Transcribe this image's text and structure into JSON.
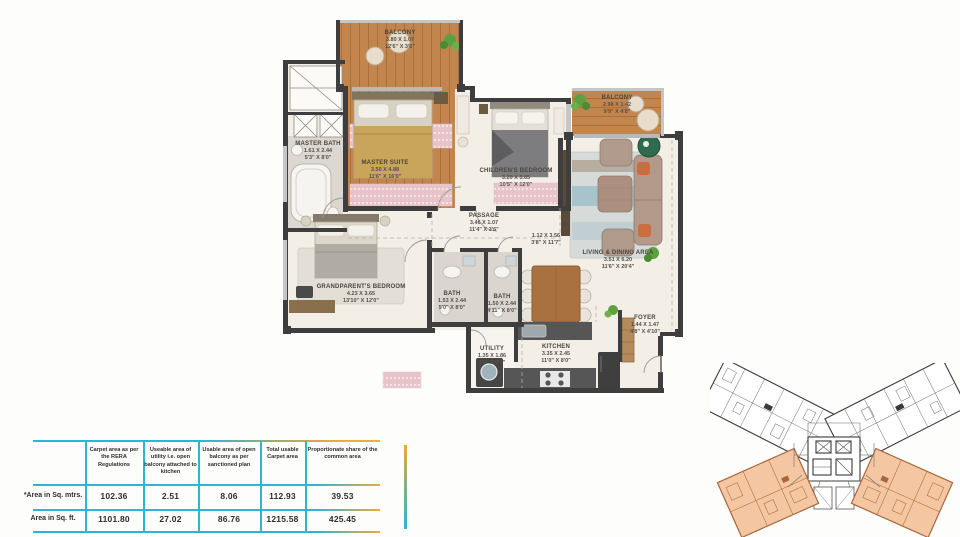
{
  "plan": {
    "rooms": [
      {
        "name": "BALCONY",
        "dim_m": "3.80 X 1.07",
        "dim_ft": "12'6\" X 3'6\""
      },
      {
        "name": "MASTER BATH",
        "dim_m": "1.61 X 2.44",
        "dim_ft": "5'3\" X 8'0\""
      },
      {
        "name": "MASTER SUITE",
        "dim_m": "3.50 X 4.88",
        "dim_ft": "11'6\" X 16'0\""
      },
      {
        "name": "CHILDREN'S BEDROOM",
        "dim_m": "3.20 X 3.65",
        "dim_ft": "10'5\" X 12'0\""
      },
      {
        "name": "BALCONY",
        "dim_m": "2.98 X 1.42",
        "dim_ft": "9'9\" X 4'8\""
      },
      {
        "name": "PASSAGE",
        "dim_m": "3.46 X 1.07",
        "dim_ft": "11'4\" X 3'6\""
      },
      {
        "name": "",
        "dim_m": "1.12 X 3.56",
        "dim_ft": "3'8\" X 11'7\""
      },
      {
        "name": "GRANDPARENT'S BEDROOM",
        "dim_m": "4.23 X 3.65",
        "dim_ft": "13'10\" X 12'0\""
      },
      {
        "name": "BATH",
        "dim_m": "1.53 X 2.44",
        "dim_ft": "5'0\" X 8'0\""
      },
      {
        "name": "BATH",
        "dim_m": "1.50 X 2.44",
        "dim_ft": "4'11\" X 8'0\""
      },
      {
        "name": "LIVING & DINING AREA",
        "dim_m": "3.51 X 6.20",
        "dim_ft": "11'6\" X 20'4\""
      },
      {
        "name": "FOYER",
        "dim_m": "1.44 X 1.47",
        "dim_ft": "4'8\" X 4'10\""
      },
      {
        "name": "UTILITY",
        "dim_m": "1.35 X 1.86",
        "dim_ft": "4'5\" X 6'1\""
      },
      {
        "name": "KITCHEN",
        "dim_m": "3.35 X 2.45",
        "dim_ft": "11'0\" X 8'0\""
      }
    ]
  },
  "area_table": {
    "col_headers": [
      "Carpet area as per the RERA Regulations",
      "Useable area of utility i.e. open balcony attached to kitchen",
      "Usable area of open balcony as per sanctioned plan",
      "Total usable Carpet area",
      "Proportionate share of the common area"
    ],
    "rows": [
      {
        "label": "*Area in Sq. mtrs.",
        "values": [
          "102.36",
          "2.51",
          "8.06",
          "112.93",
          "39.53"
        ]
      },
      {
        "label": "Area in Sq. ft.",
        "values": [
          "1101.80",
          "27.02",
          "86.76",
          "1215.58",
          "425.45"
        ]
      }
    ]
  },
  "key_plan": {
    "highlighted_units": "2"
  },
  "colors": {
    "accent_cyan": "#2ab7d2",
    "accent_orange": "#f0a93c",
    "wall": "#3e3e3e",
    "wood": "#c2854d",
    "unit_highlight": "#f4c7a2"
  }
}
